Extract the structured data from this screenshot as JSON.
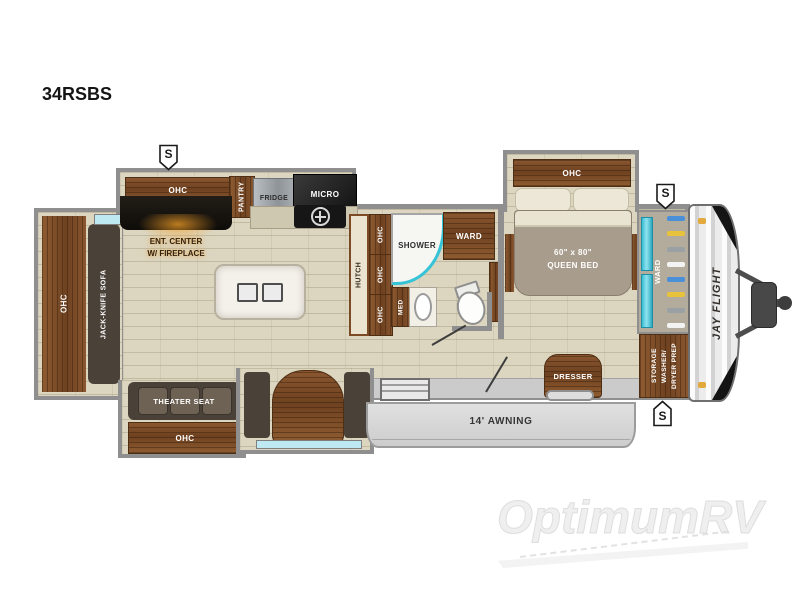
{
  "model": "34RSBS",
  "watermark": "OptimumRV",
  "brand": "JAY FLIGHT",
  "speaker_symbol": "S",
  "colors": {
    "teal": "#35c3d8",
    "wood": "#80522b",
    "fireplace_glow": "#f0a030",
    "awning_gray": "#d6d6d6"
  },
  "labels": {
    "rear_ohc": "OHC",
    "jack_knife_sofa": "JACK-KNIFE SOFA",
    "kitchen_ohc": "OHC",
    "pantry": "PANTRY",
    "fridge": "FRIDGE",
    "micro": "MICRO",
    "ent_center_1": "ENT. CENTER",
    "ent_center_2": "W/ FIREPLACE",
    "hutch": "HUTCH",
    "ohc": "OHC",
    "med": "MED",
    "shower": "SHOWER",
    "bath_ward": "WARD",
    "bed_ohc": "OHC",
    "queen_bed_1": "60\" x 80\"",
    "queen_bed_2": "QUEEN BED",
    "front_ward": "WARD",
    "storage_1": "STORAGE",
    "storage_2": "WASHER/",
    "storage_3": "DRYER PREP",
    "theater_seat": "THEATER SEAT",
    "theater_ohc": "OHC",
    "dresser": "DRESSER",
    "awning": "14' AWNING"
  }
}
